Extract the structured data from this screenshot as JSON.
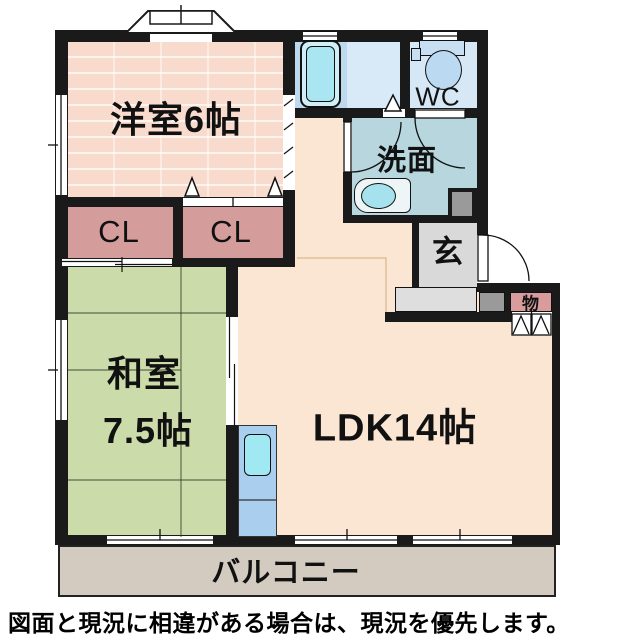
{
  "plan": {
    "type": "apartment-floor-plan",
    "rooms": {
      "western_room": {
        "label": "洋室6帖"
      },
      "closet1": {
        "label": "CL"
      },
      "closet2": {
        "label": "CL"
      },
      "japanese_room": {
        "label_line1": "和室",
        "label_line2": "7.5帖"
      },
      "ldk": {
        "label": "LDK14帖"
      },
      "washroom": {
        "label": "洗面"
      },
      "wc": {
        "label": "WC"
      },
      "entrance": {
        "label": "玄"
      },
      "storage": {
        "label": "物"
      },
      "balcony": {
        "label": "バルコニー"
      }
    },
    "fixtures": [
      "bathtub",
      "toilet",
      "wash-basin",
      "kitchen-sink"
    ],
    "disclaimer": "図面と現況に相違がある場合は、現況を優先します。"
  },
  "colors": {
    "wall": "#1a1a1a",
    "western_room_fill": "#f8dbcc",
    "closet_fill": "#d59c9c",
    "japanese_room_fill": "#ccdbaa",
    "ldk_fill": "#fae6d3",
    "bath_fill": "#bcd9ee",
    "bath_floor_fill": "#d8eaf7",
    "wc_fill": "#d6e8f5",
    "washroom_fill": "#b7d6de",
    "entrance_fill": "#d9d9d9",
    "storage_fill": "#d89c9c",
    "balcony_fill": "#d4cbc0",
    "kitchen_fill": "#aacfee",
    "sink_fill": "#a0e8f2",
    "pillar_fill": "#9a9a9a"
  }
}
